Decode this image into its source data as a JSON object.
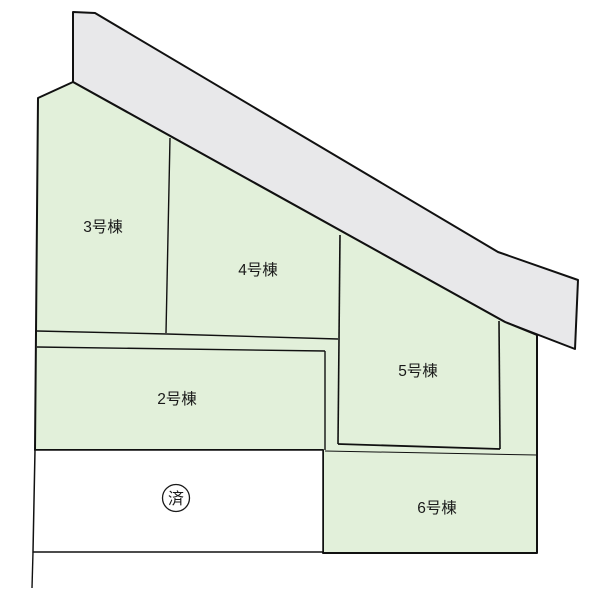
{
  "diagram": {
    "type": "real-estate-site-plan",
    "road_label": "",
    "colors": {
      "lot_green": "#e2f0da",
      "road_gray": "#e8e8ea",
      "sold_white": "#ffffff",
      "line_black": "#111111",
      "text": "#1a1a1a"
    },
    "lots": [
      {
        "id": "lot-3",
        "label": "3号棟",
        "status": "available"
      },
      {
        "id": "lot-4",
        "label": "4号棟",
        "status": "available"
      },
      {
        "id": "lot-5",
        "label": "5号棟",
        "status": "available"
      },
      {
        "id": "lot-2",
        "label": "2号棟",
        "status": "available"
      },
      {
        "id": "lot-6",
        "label": "6号棟",
        "status": "available"
      },
      {
        "id": "lot-sold",
        "label": "済",
        "status": "sold"
      }
    ]
  }
}
